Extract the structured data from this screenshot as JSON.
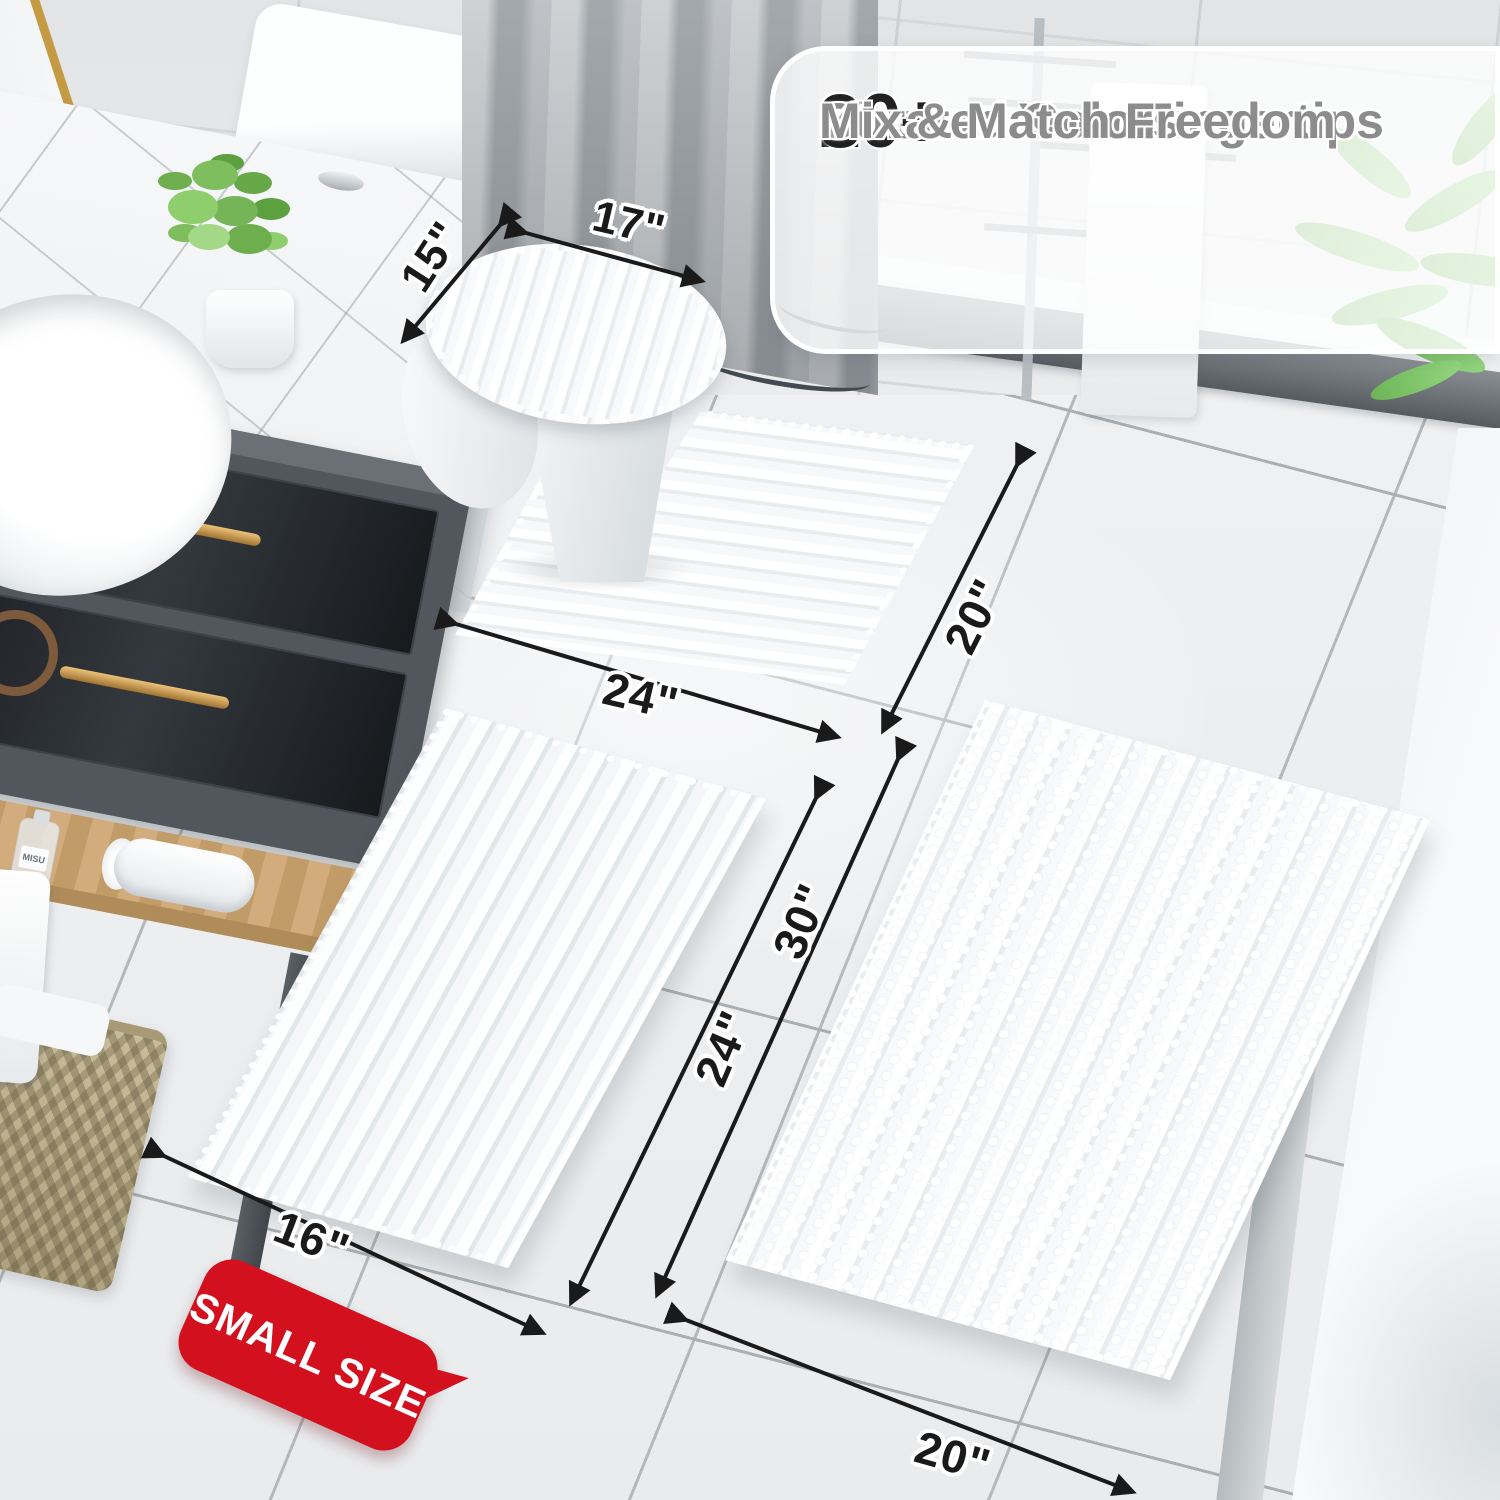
{
  "banner": {
    "check_icon": "✔",
    "items": [
      {
        "stat": "20+",
        "label": "Sizes at Your Fingertips"
      },
      {
        "stat": "30+",
        "label": "Curated Colors"
      },
      {
        "stat": "",
        "label": "Mix & Match Freedom"
      }
    ]
  },
  "dimensions": {
    "lid_width": "15\"",
    "lid_length": "17\"",
    "contour_width": "24\"",
    "contour_depth": "20\"",
    "small_rug_width": "16\"",
    "small_rug_length": "24\"",
    "large_rug_length": "30\"",
    "large_rug_width": "20\""
  },
  "badge": {
    "text": "SMALL SIZE"
  },
  "scene": {
    "bottle_label": "MISU"
  },
  "colors": {
    "badge_red": "#d2101e",
    "arrow_black": "#1a1a1a",
    "stat_black": "#212121",
    "label_gray": "#8c8c8c",
    "check_gray": "#9a9a9a",
    "gold_accent": "#c49a43"
  }
}
